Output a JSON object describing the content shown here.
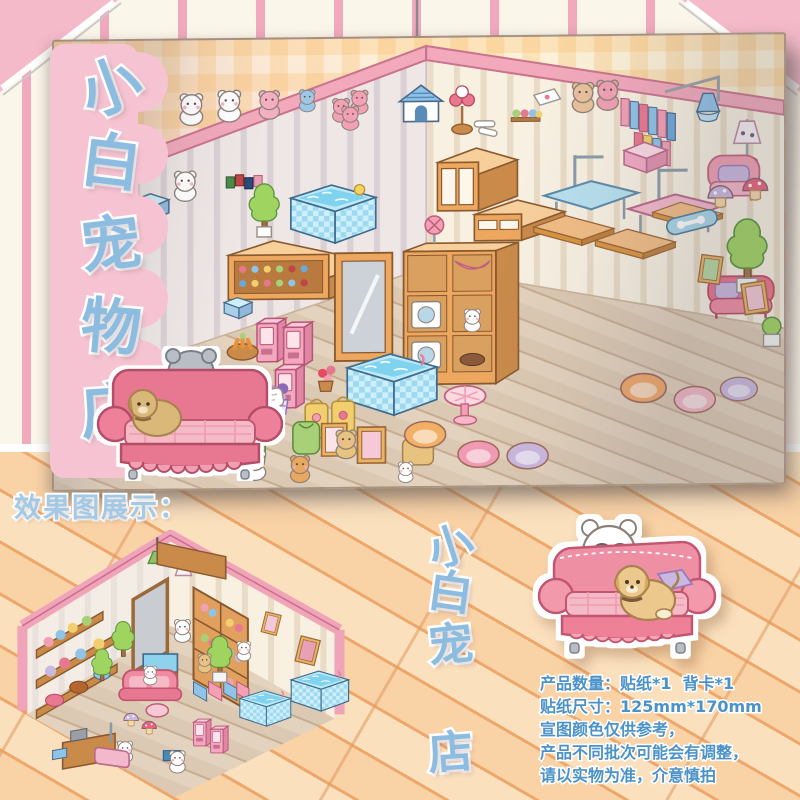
{
  "titles": {
    "store_name": "小白宠物店",
    "left_chars": [
      "小",
      "白",
      "宠",
      "物",
      "店"
    ],
    "bottom_chars": [
      "小",
      "白",
      "宠",
      "物",
      "店"
    ]
  },
  "effect_section": {
    "label": "效果图展示："
  },
  "product_info": {
    "lines": [
      "产品数量：贴纸*1  背卡*1",
      "贴纸尺寸：125mm*170mm",
      "宣图颜色仅供参考，",
      "产品不同批次可能会有调整，",
      "请以实物为准，介意慎拍"
    ]
  },
  "colors": {
    "title_blue": "#8cbcdf",
    "label_blue": "#a2c9e6",
    "info_blue": "#4b92c8",
    "ribbon_pink": "#f6c3d2",
    "wall_stripe_pink": "#f1a9be",
    "floor_orange": "#f7c99b",
    "sheet_cream": "#fdf2d8",
    "room_wall_pink": "#f2a9bc",
    "pool_blue": "#8fd2ee",
    "sofa_pink": "#ee8098",
    "wood": "#eda75f"
  },
  "illustration": {
    "main_sheet_items": [
      "white-cat",
      "plush-bear-pile",
      "dog-house",
      "flower-stand",
      "bone-toys",
      "yarn-shelf",
      "plush-dolls",
      "book-stacks",
      "tutu-dress",
      "doll-lamp",
      "pink-armchair",
      "hot-tub-pool",
      "wall-cabinet",
      "grooming-table-blue",
      "grooming-table-pink",
      "tv-stand",
      "wood-planks",
      "red-sofa",
      "snack-counter",
      "vending-machine",
      "standing-mirror",
      "display-shelf",
      "round-table",
      "pet-beds",
      "mushroom-stools",
      "topiary-tree",
      "skateboard",
      "picture-frames",
      "puppies",
      "ducklings",
      "gift-bags",
      "pet-outfits"
    ],
    "corner_sticker": "gray-bear-and-puppy-on-pink-sofa",
    "bottom_sticker": "white-bear-and-puppy-on-pink-sofa",
    "effect_image": "assembled-pet-shop-room"
  }
}
